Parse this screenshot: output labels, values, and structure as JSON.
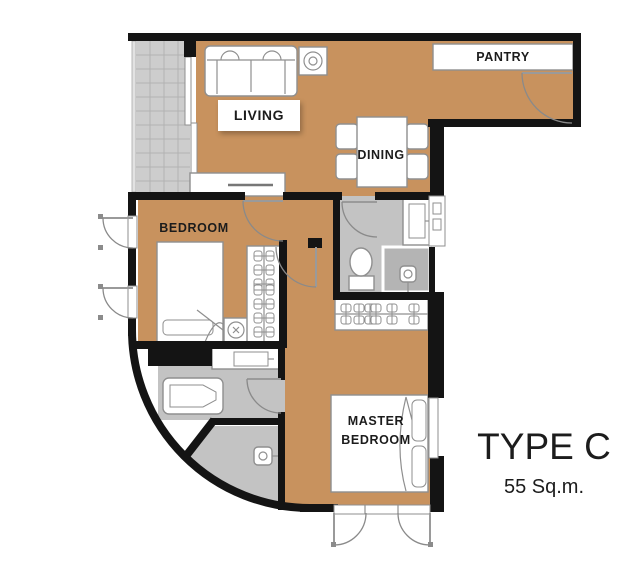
{
  "plan": {
    "type_label": "TYPE C",
    "area_label": "55 Sq.m."
  },
  "rooms": {
    "living": "LIVING",
    "dining": "DINING",
    "bedroom": "BEDROOM",
    "master_line1": "MASTER",
    "master_line2": "BEDROOM",
    "pantry": "PANTRY"
  },
  "fixtures": [
    "sofa",
    "fan-coil-unit",
    "tv-console",
    "dining-table-with-4-chairs",
    "pantry-counter",
    "single-bed",
    "bedroom-closet-hangers",
    "master-wardrobe-hangers",
    "toilet",
    "shower",
    "basin-counter",
    "bathtub",
    "master-bed",
    "balcony-tiles",
    "door-swings",
    "windows"
  ],
  "colors": {
    "bg": "#ffffff",
    "floor": "#c8925e",
    "tile": "#cdcdcd",
    "tileline": "#b2b2b2",
    "bath": "#c3c3c3",
    "bathdark": "#b4b4b4",
    "wall": "#141414",
    "line": "#8f8f8f",
    "text": "#1c1c1c"
  }
}
